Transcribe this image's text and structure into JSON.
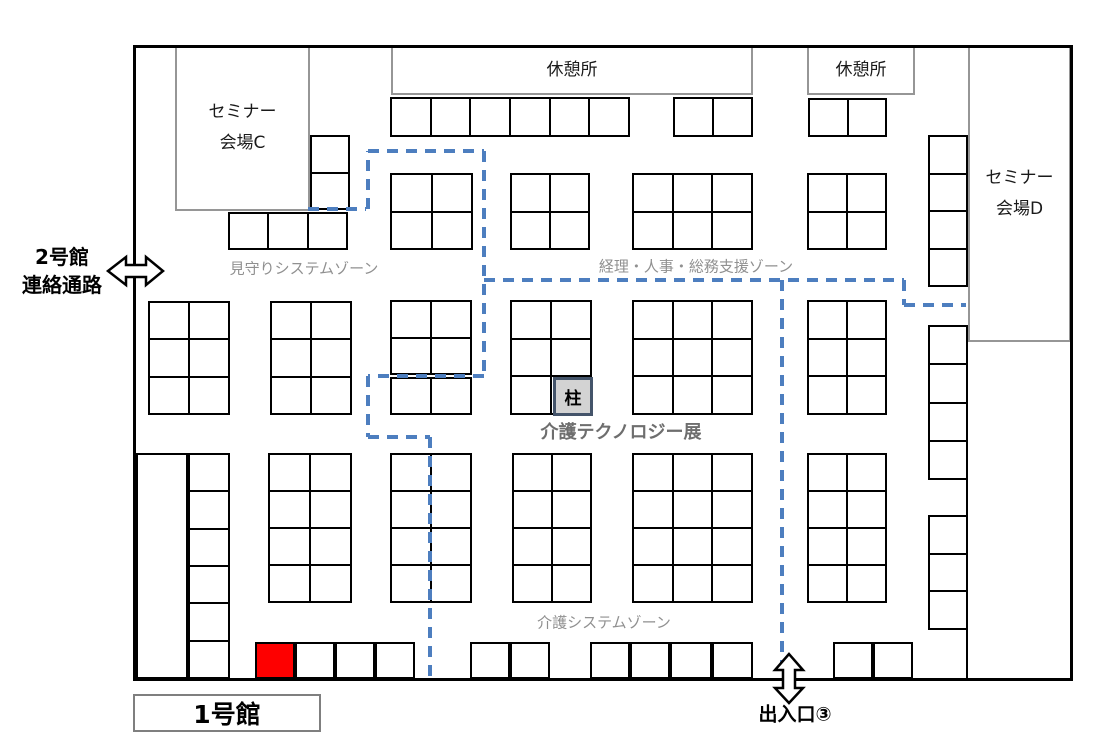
{
  "palette": {
    "route_blue": "#4d7ebf",
    "booth_line": "#000000",
    "highlight_red": "#fe0000",
    "pillar_fill": "#d3d3d3",
    "pillar_border": "#44546a",
    "zone_text": "#909090",
    "room_border": "#969696",
    "wall": "#000000"
  },
  "labels": {
    "building2_line1": "2号館",
    "building2_line2": "連絡通路",
    "building1": "1号館",
    "exit3": "出入口③",
    "rest_area": "休憩所",
    "seminar_c_line1": "セミナー",
    "seminar_c_line2": "会場C",
    "seminar_d_line1": "セミナー",
    "seminar_d_line2": "会場D",
    "zone_monitoring": "見守りシステムゾーン",
    "zone_admin": "経理・人事・総務支援ゾーン",
    "zone_care_system": "介護システムゾーン",
    "exhibition_title": "介護テクノロジー展",
    "pillar": "柱"
  },
  "floor": {
    "blocks": [
      {
        "x": 390,
        "y": 97,
        "cols": 6,
        "rows": 1,
        "cw": 40,
        "ch": 40
      },
      {
        "x": 673,
        "y": 97,
        "cols": 2,
        "rows": 1,
        "cw": 40,
        "ch": 40
      },
      {
        "x": 808,
        "y": 98,
        "cols": 2,
        "rows": 1,
        "cw": 39.5,
        "ch": 39
      },
      {
        "x": 310,
        "y": 135,
        "cols": 1,
        "rows": 2,
        "cw": 40,
        "ch": 37.5
      },
      {
        "x": 228,
        "y": 212,
        "cols": 3,
        "rows": 1,
        "cw": 40,
        "ch": 38
      },
      {
        "x": 390,
        "y": 173,
        "cols": 2,
        "rows": 2,
        "cw": 41.5,
        "ch": 38.5
      },
      {
        "x": 510,
        "y": 173,
        "cols": 2,
        "rows": 2,
        "cw": 40,
        "ch": 38.5
      },
      {
        "x": 632,
        "y": 173,
        "cols": 3,
        "rows": 2,
        "cw": 40.3,
        "ch": 38.5
      },
      {
        "x": 807,
        "y": 173,
        "cols": 2,
        "rows": 2,
        "cw": 40,
        "ch": 38.5
      },
      {
        "x": 928,
        "y": 135,
        "cols": 1,
        "rows": 4,
        "cw": 40,
        "ch": 38
      },
      {
        "x": 148,
        "y": 301,
        "cols": 2,
        "rows": 3,
        "cw": 41,
        "ch": 38
      },
      {
        "x": 270,
        "y": 301,
        "cols": 2,
        "rows": 3,
        "cw": 41,
        "ch": 38
      },
      {
        "x": 390,
        "y": 300,
        "cols": 2,
        "rows": 2,
        "cw": 41,
        "ch": 37.5
      },
      {
        "x": 390,
        "y": 377,
        "cols": 2,
        "rows": 1,
        "cw": 41,
        "ch": 38
      },
      {
        "x": 510,
        "y": 300,
        "cols": 2,
        "rows": 3,
        "cw": 41,
        "ch": 38.3
      },
      {
        "x": 632,
        "y": 300,
        "cols": 3,
        "rows": 3,
        "cw": 40.3,
        "ch": 38.3
      },
      {
        "x": 807,
        "y": 300,
        "cols": 2,
        "rows": 3,
        "cw": 40,
        "ch": 38.3
      },
      {
        "x": 928,
        "y": 325,
        "cols": 1,
        "rows": 4,
        "cw": 40,
        "ch": 38.75
      },
      {
        "x": 136,
        "y": 453,
        "cols": 1,
        "rows": 1,
        "cw": 52,
        "ch": 226,
        "name": "side-open-area"
      },
      {
        "x": 188,
        "y": 453,
        "cols": 1,
        "rows": 6,
        "cw": 42,
        "ch": 37.7
      },
      {
        "x": 268,
        "y": 453,
        "cols": 2,
        "rows": 4,
        "cw": 42,
        "ch": 37.5
      },
      {
        "x": 390,
        "y": 453,
        "cols": 2,
        "rows": 4,
        "cw": 41,
        "ch": 37.5
      },
      {
        "x": 512,
        "y": 453,
        "cols": 2,
        "rows": 4,
        "cw": 40,
        "ch": 37.5
      },
      {
        "x": 632,
        "y": 453,
        "cols": 3,
        "rows": 4,
        "cw": 40.3,
        "ch": 37.5
      },
      {
        "x": 807,
        "y": 453,
        "cols": 2,
        "rows": 4,
        "cw": 40,
        "ch": 37.5
      },
      {
        "x": 928,
        "y": 515,
        "cols": 1,
        "rows": 3,
        "cw": 40,
        "ch": 38.3
      },
      {
        "x": 255,
        "y": 642,
        "cols": 1,
        "rows": 1,
        "cw": 40,
        "ch": 37,
        "fill": "#fe0000",
        "name": "highlighted-booth"
      },
      {
        "x": 295,
        "y": 642,
        "cols": 1,
        "rows": 1,
        "cw": 40,
        "ch": 37
      },
      {
        "x": 335,
        "y": 642,
        "cols": 1,
        "rows": 1,
        "cw": 40,
        "ch": 37
      },
      {
        "x": 375,
        "y": 642,
        "cols": 1,
        "rows": 1,
        "cw": 40,
        "ch": 37
      },
      {
        "x": 470,
        "y": 642,
        "cols": 1,
        "rows": 1,
        "cw": 40,
        "ch": 37
      },
      {
        "x": 510,
        "y": 642,
        "cols": 1,
        "rows": 1,
        "cw": 40,
        "ch": 37
      },
      {
        "x": 590,
        "y": 642,
        "cols": 1,
        "rows": 1,
        "cw": 40,
        "ch": 37
      },
      {
        "x": 630,
        "y": 642,
        "cols": 1,
        "rows": 1,
        "cw": 40,
        "ch": 37
      },
      {
        "x": 670,
        "y": 642,
        "cols": 1,
        "rows": 1,
        "cw": 42,
        "ch": 37
      },
      {
        "x": 712,
        "y": 642,
        "cols": 1,
        "rows": 1,
        "cw": 41,
        "ch": 37
      },
      {
        "x": 833,
        "y": 642,
        "cols": 1,
        "rows": 1,
        "cw": 40,
        "ch": 37
      },
      {
        "x": 873,
        "y": 642,
        "cols": 1,
        "rows": 1,
        "cw": 40,
        "ch": 37
      }
    ],
    "route_segments": [
      [
        308,
        209,
        366,
        209
      ],
      [
        368,
        209,
        368,
        151
      ],
      [
        368,
        151,
        484,
        151
      ],
      [
        484,
        151,
        484,
        376
      ],
      [
        484,
        376,
        368,
        376
      ],
      [
        368,
        376,
        368,
        437
      ],
      [
        368,
        437,
        430,
        437
      ],
      [
        430,
        437,
        430,
        679
      ],
      [
        484,
        280,
        904,
        280
      ],
      [
        904,
        280,
        904,
        305
      ],
      [
        904,
        305,
        966,
        305
      ],
      [
        782,
        280,
        782,
        679
      ]
    ],
    "arrows": [
      {
        "name": "building2-double-arrow-icon",
        "points": "108,271 126,257 126,265 146,265 146,257 163,271 146,285 146,277 126,277 126,285"
      },
      {
        "name": "exit3-double-arrow-icon",
        "points": "789,654 775,670 783,670 783,688 775,688 789,703 803,688 795,688 795,670 803,670"
      }
    ]
  }
}
